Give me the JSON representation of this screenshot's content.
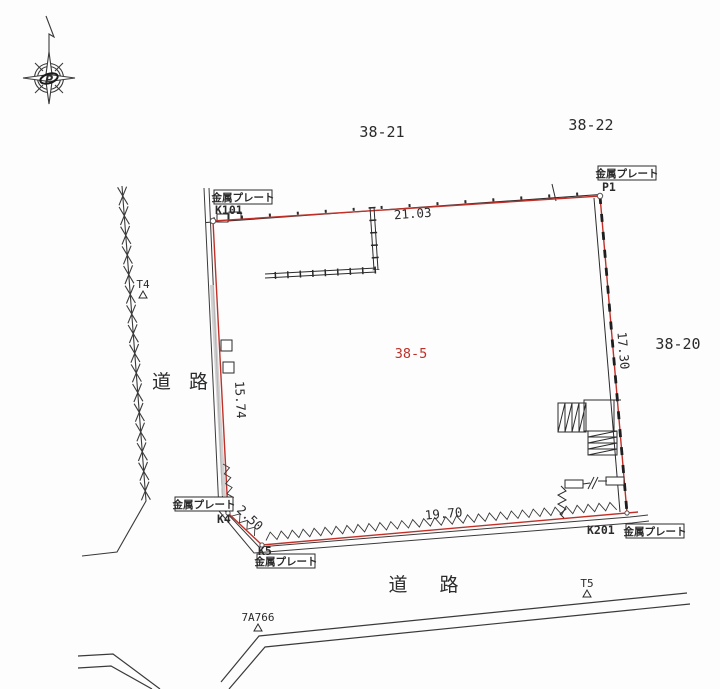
{
  "colors": {
    "boundary_red": "#c03028",
    "line_black": "#2b2b2b"
  },
  "compass": {
    "logo": "P"
  },
  "parcels": {
    "main": "38-5",
    "neighbor_top_left": "38-21",
    "neighbor_top_right": "38-22",
    "neighbor_right": "38-20"
  },
  "roads": {
    "left": "道 路",
    "bottom": "道 路"
  },
  "plates": {
    "label": "金属プレート"
  },
  "points": {
    "k101": "K101",
    "p1": "P1",
    "k4": "K4",
    "k5": "K5",
    "k201": "K201"
  },
  "benchmarks": {
    "t4": "T4",
    "t5": "T5",
    "ref": "7A766"
  },
  "measurements": {
    "top": "21.03",
    "right": "17.30",
    "left": "15.74",
    "chamfer": "2.50",
    "bottom": "19.70"
  }
}
